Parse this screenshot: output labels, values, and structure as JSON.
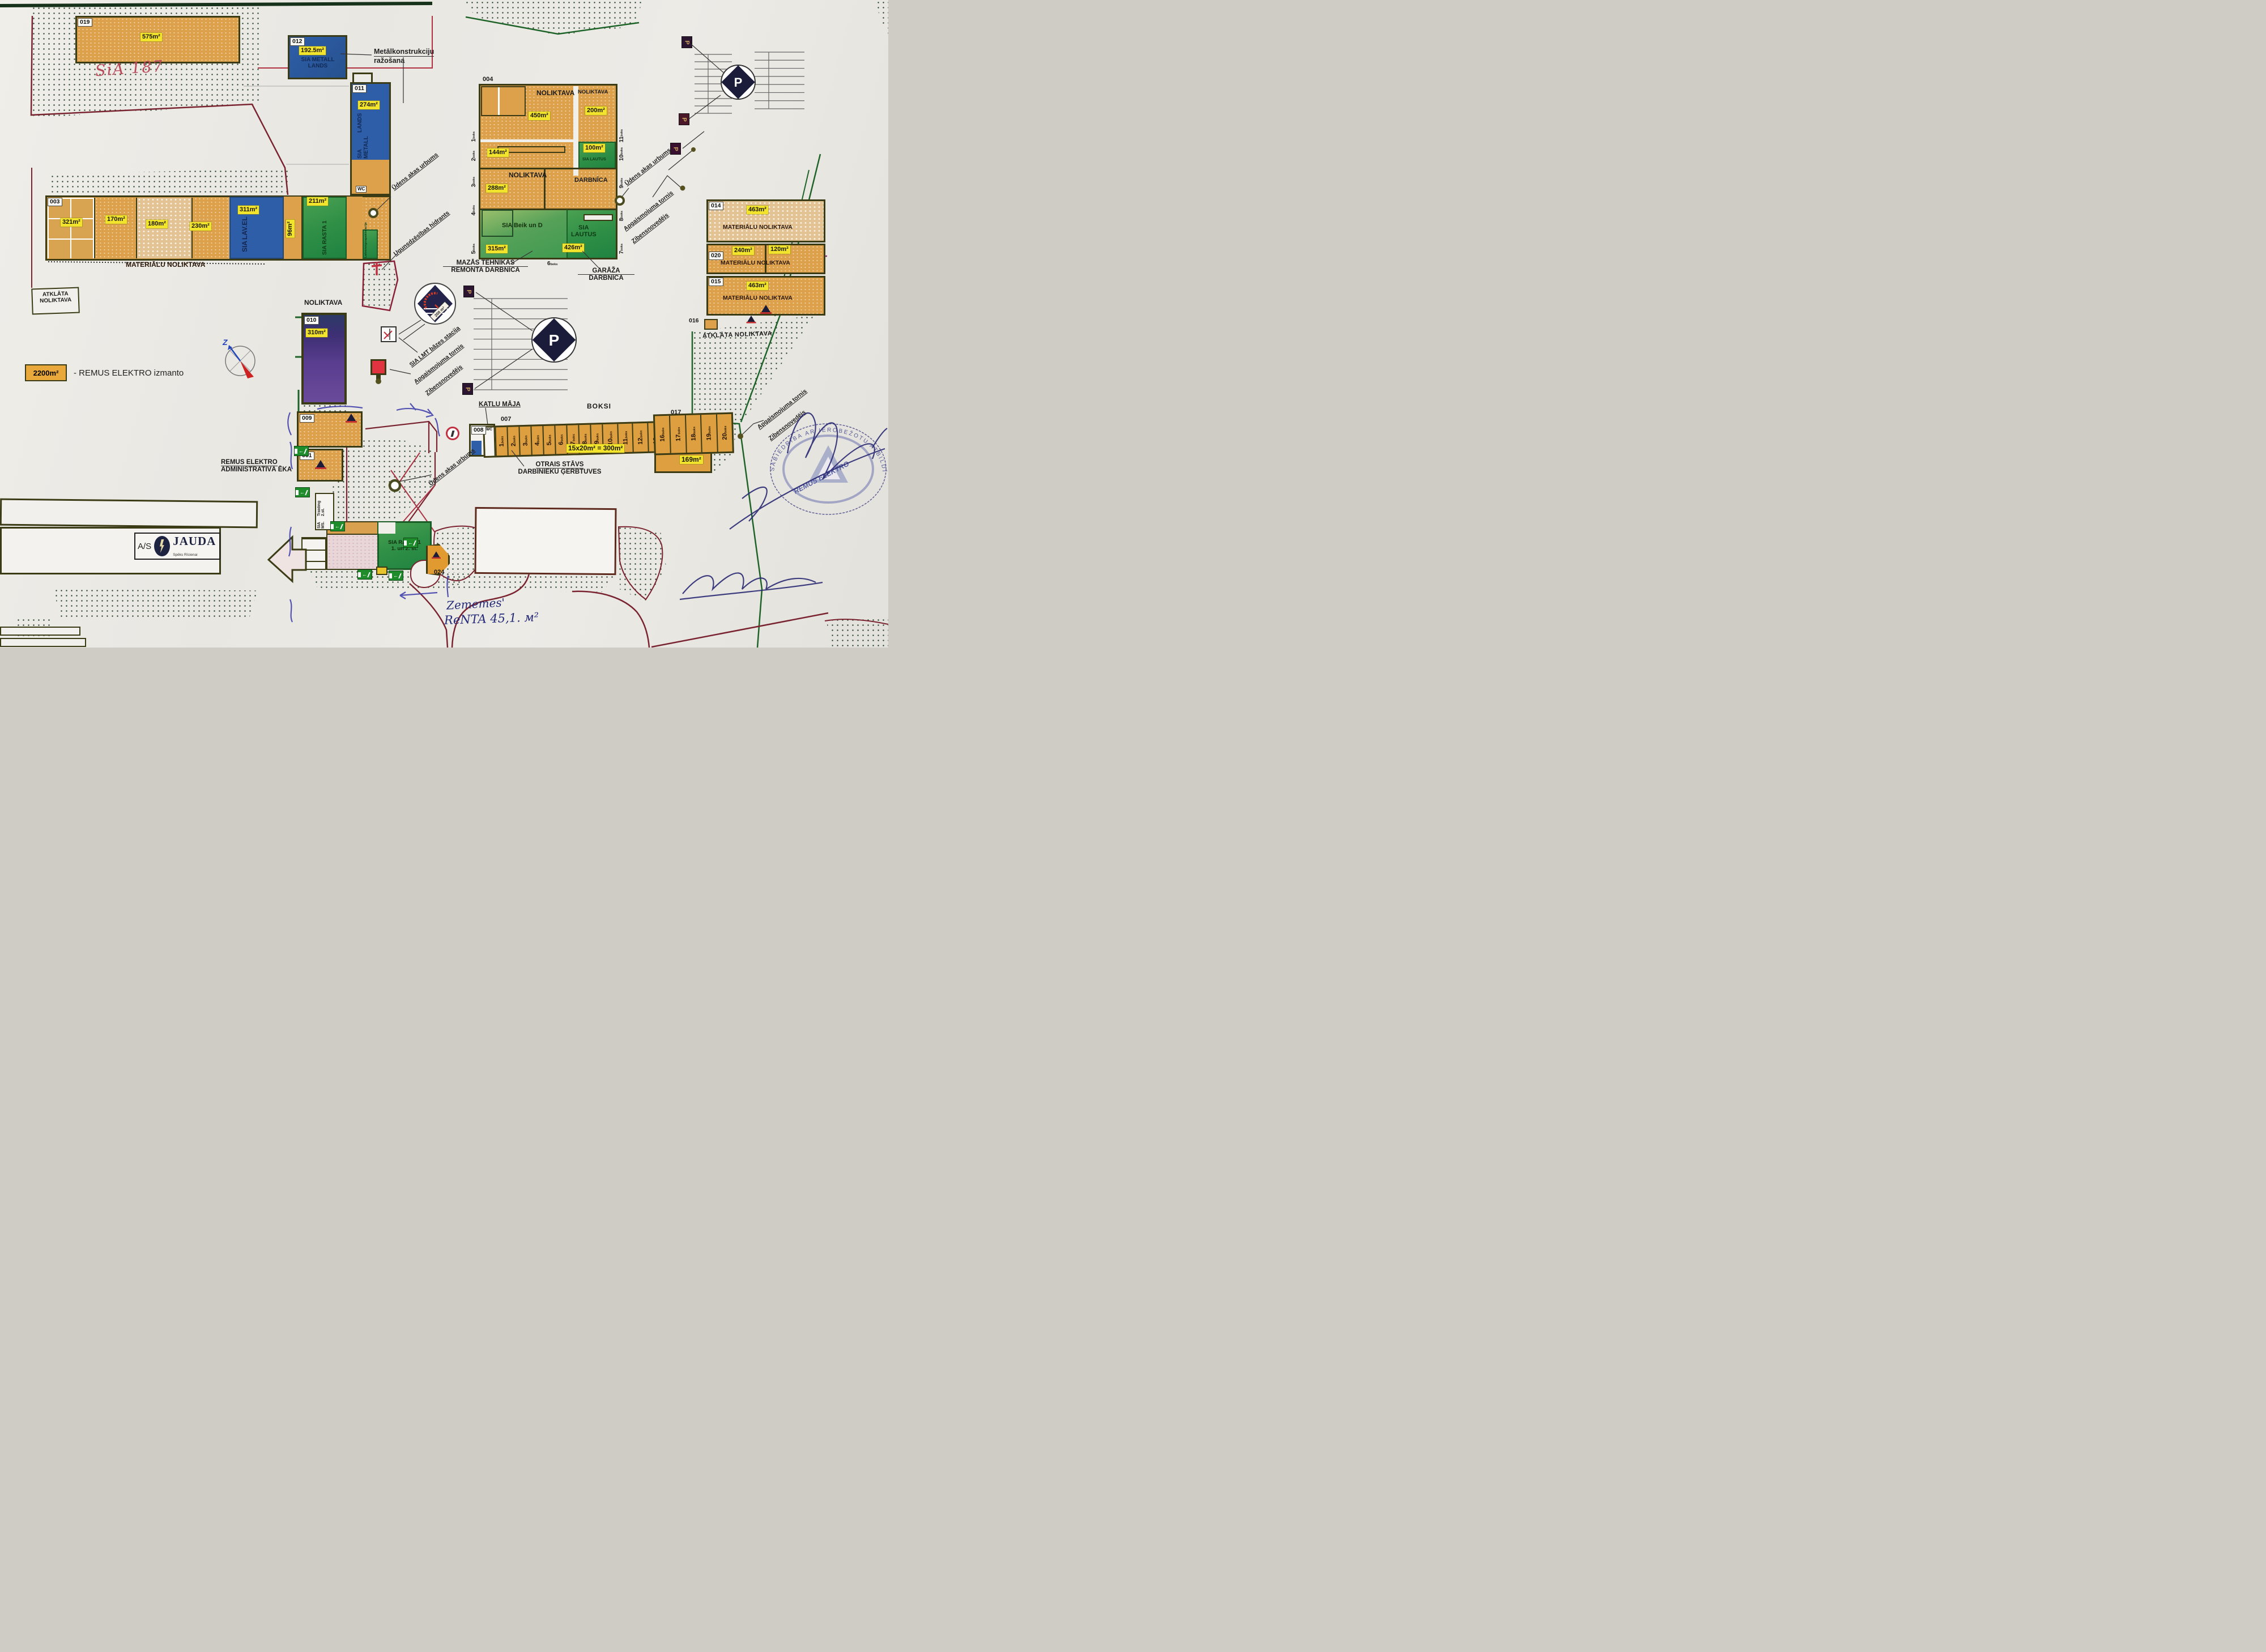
{
  "colors": {
    "chip_yellow": "#f2e42c",
    "building_orange": "#dd9f3f",
    "building_blue": "#2e5ea8",
    "building_green": "#3c9a44",
    "building_purple": "#5a3d8f",
    "boundary_green": "#1d6328",
    "boundary_maroon": "#7a2330",
    "ink_blue": "#2a2a74",
    "hand_red": "#b84858"
  },
  "legend": {
    "area": "2200m²",
    "label": "- REMUS ELEKTRO izmanto"
  },
  "compass": {
    "north": "Z"
  },
  "handwriting": {
    "top": "SiA 187",
    "line1": "Zememes'",
    "line2": "ReNTA 45,1. м²"
  },
  "b019": {
    "tag": "019",
    "area": "575m²"
  },
  "b012": {
    "tag": "012",
    "area": "192.5m²",
    "name1": "SIA METALL",
    "name2": "LANDS"
  },
  "b011": {
    "tag": "011",
    "area": "274m²",
    "name1": "SIA METALL",
    "name2": "LANDS",
    "wc": "WC"
  },
  "metal": {
    "line1": "Metālkonstrukciju",
    "line2": "ražošana"
  },
  "b003": {
    "tag": "003",
    "a1": "321m²",
    "a2": "170m²",
    "a3": "180m²",
    "a4": "230m²",
    "blue_area": "311m²",
    "blue1": "SIA",
    "blue2": "LAV.EL",
    "a5": "96m²",
    "green_area": "211m²",
    "green_name": "SIA RASTA 1",
    "sub1": "Latvenergo",
    "sub2": "apakšstacija",
    "caption": "MATERIĀLU NOLIKTAVA"
  },
  "b004": {
    "tag": "004",
    "n1": "NOLIKTAVA",
    "n1a": "450m²",
    "n2": "NOLIKTAVA",
    "n2a": "200m²",
    "r144": "144m²",
    "l1a": "100m²",
    "l1n": "SIA LAUTUS",
    "n3": "NOLIKTAVA",
    "n3a": "288m²",
    "darb": "DARBNĪCA",
    "beik": "SIA Beik un D",
    "beik_a": "315m²",
    "l2n1": "SIA",
    "l2n2": "LAUTUS",
    "l2a": "426m²",
    "bl": [
      "1",
      "2",
      "3",
      "4",
      "5"
    ],
    "bb": "6",
    "br": [
      "7",
      "8",
      "9",
      "10",
      "11"
    ],
    "suffix": "boks"
  },
  "mazas": {
    "line1": "MAZĀS TEHNIKAS",
    "line2": "REMONTA DARBNĪCA"
  },
  "garaza": {
    "line1": "GARĀŽA",
    "line2": "DARBNĪCA"
  },
  "b014": {
    "tag": "014",
    "area": "463m²",
    "caption": "MATERIĀLU NOLIKTAVA"
  },
  "b020": {
    "tag": "020",
    "a1": "240m²",
    "a2": "120m²",
    "caption": "MATERIĀLU NOLIKTAVA"
  },
  "b015": {
    "tag": "015",
    "area": "463m²",
    "caption": "MATERIĀLU NOLIKTAVA"
  },
  "b016": {
    "tag": "016"
  },
  "b010": {
    "tag": "010",
    "area": "310m²",
    "caption": "NOLIKTAVA"
  },
  "b009": {
    "tag": "009"
  },
  "b001": {
    "tag": "001"
  },
  "b008": {
    "tag": "008"
  },
  "b007": {
    "tag": "007"
  },
  "b017": {
    "tag": "017",
    "area": "169m²"
  },
  "b024": {
    "tag": "024"
  },
  "atklata_left": {
    "line1": "ATKLĀTA",
    "line2": "NOLIKTAVA"
  },
  "atklata_right": "ATKLĀTA NOLIKTAVA",
  "labels": {
    "udens": "Ūdens akas urbums",
    "apgaismojuma": "Apgaismojuma tornis",
    "zibens": "Zibensnovedējs",
    "hidrants": "Ugunsdzēsības hidrants",
    "lmt": "SIA LMT bāzes stacija",
    "tower": "200 m³"
  },
  "remus": {
    "line1": "REMUS ELEKTRO",
    "line2": "ADMINISTRATĪVĀ ĒKA"
  },
  "sia_ms": {
    "line1": "SIA MS.",
    "line2": "Traiding 2.st."
  },
  "rasta": {
    "line1": "SIA RASTA 1",
    "line2": "1. un 2. st."
  },
  "boksi": {
    "title": "BOKSI",
    "katlu": "KATLU MĀJA",
    "wc": "WC",
    "numbers": [
      "1",
      "2",
      "3",
      "4",
      "5",
      "6",
      "7",
      "8",
      "9",
      "10",
      "11",
      "12",
      "13",
      "14",
      "15",
      "16",
      "17",
      "18",
      "19",
      "20"
    ],
    "suffix": "boks",
    "chip": "15x20m² = 300m²",
    "otrais1": "OTRAIS STĀVS",
    "otrais2": "DARBINIEKU ĢERBTUVES"
  },
  "jauda": {
    "prefix": "A/S",
    "name": "JAUDA",
    "tagline": "Spēks Rīcienai"
  },
  "stamp": {
    "ring": "SABIEDRĪBA AR IEROBEŽOTU ATBILDĪBU",
    "center": "REMUS ELEKTRO"
  }
}
